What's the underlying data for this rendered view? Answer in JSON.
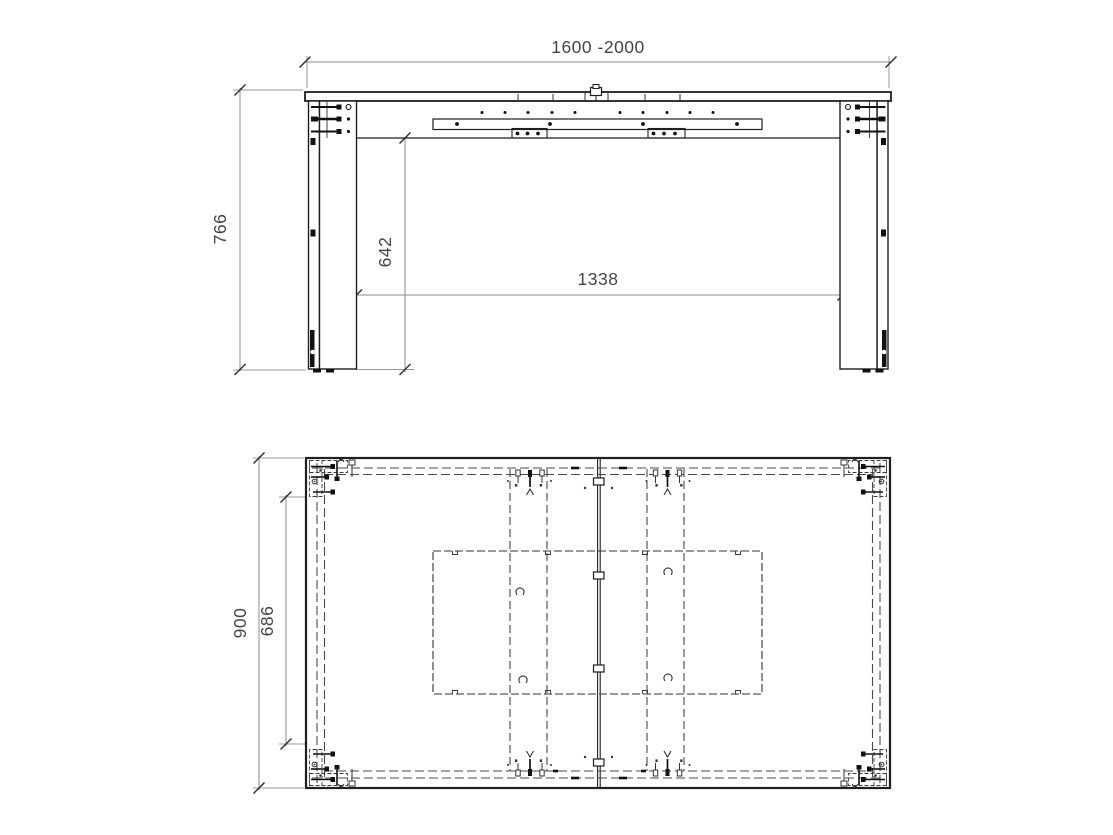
{
  "drawing": {
    "type": "technical-drawing",
    "subject": "extendable-table",
    "front_view": {
      "width_range": "1600 -2000",
      "overall_height": "766",
      "underframe_clearance": "642",
      "leg_inner_span": "1338"
    },
    "top_view": {
      "overall_depth": "900",
      "inner_depth": "686"
    },
    "colors": {
      "background": "#ffffff",
      "line": "#1f1f1f",
      "hidden_line": "#4a4a4a",
      "dimension_line": "#8c8c8c",
      "text": "#454545"
    }
  }
}
